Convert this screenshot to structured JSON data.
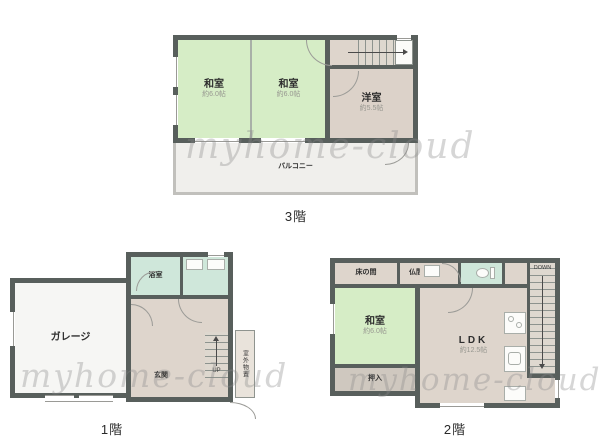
{
  "watermark": "myhome-cloud",
  "floor3": {
    "caption": "3階",
    "washitsu1": {
      "name": "和室",
      "size": "約6.0帖"
    },
    "washitsu2": {
      "name": "和室",
      "size": "約6.0帖"
    },
    "youshitsu": {
      "name": "洋室",
      "size": "約5.5帖"
    },
    "balcony_label": "バルコニー"
  },
  "floor1": {
    "caption": "1階",
    "garage_label": "ガレージ",
    "bath_label": "浴室",
    "entrance_label": "玄関",
    "stairs_label": "UP",
    "storage_label": "室外物置"
  },
  "floor2": {
    "caption": "2階",
    "tokonoma_label": "床の間",
    "butsuma_label": "仏間",
    "washitsu": {
      "name": "和室",
      "size": "約6.0帖"
    },
    "oshiire_label": "押入",
    "ldk": {
      "name": "LDK",
      "size": "約12.5帖"
    },
    "stairs_label": "DOWN"
  },
  "colors": {
    "wall": "#585f5c",
    "tatami_green": "#d6edc6",
    "room_beige": "#ded5cc",
    "mint": "#cfe7da",
    "closet_gray": "#cfc8bf",
    "balcony_gray": "#f0efec",
    "garage_white": "#f6f6f4",
    "watermark_gray": "#c9c9c9"
  }
}
